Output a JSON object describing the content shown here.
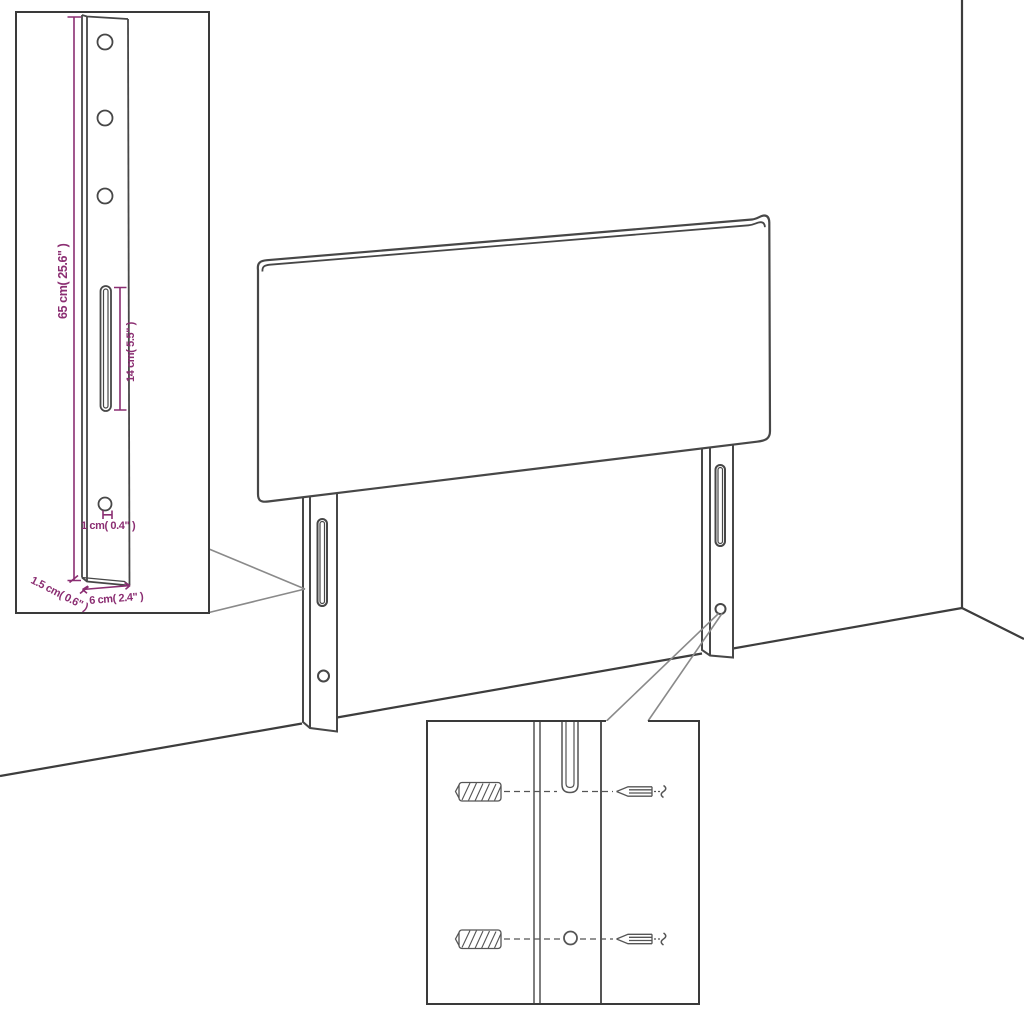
{
  "diagram": {
    "colors": {
      "line": "#474747",
      "room_line": "#3d3d3d",
      "inset_border": "#3a3a3a",
      "callout": "#8a8a8a",
      "dimension": "#8b2e72",
      "hardware": "#555555",
      "background": "#ffffff"
    },
    "bracket_detail": {
      "dim_height": "65 cm( 25.6\" )",
      "dim_slot": "14 cm( 5.5\" )",
      "dim_hole": "1 cm( 0.4\" )",
      "dim_thickness": "1.5 cm( 0.6\" )",
      "dim_width": "6 cm( 2.4\" )",
      "hole_count": 3
    },
    "mounting_detail": {
      "wall_plug_count": 2,
      "screw_count": 2
    }
  }
}
